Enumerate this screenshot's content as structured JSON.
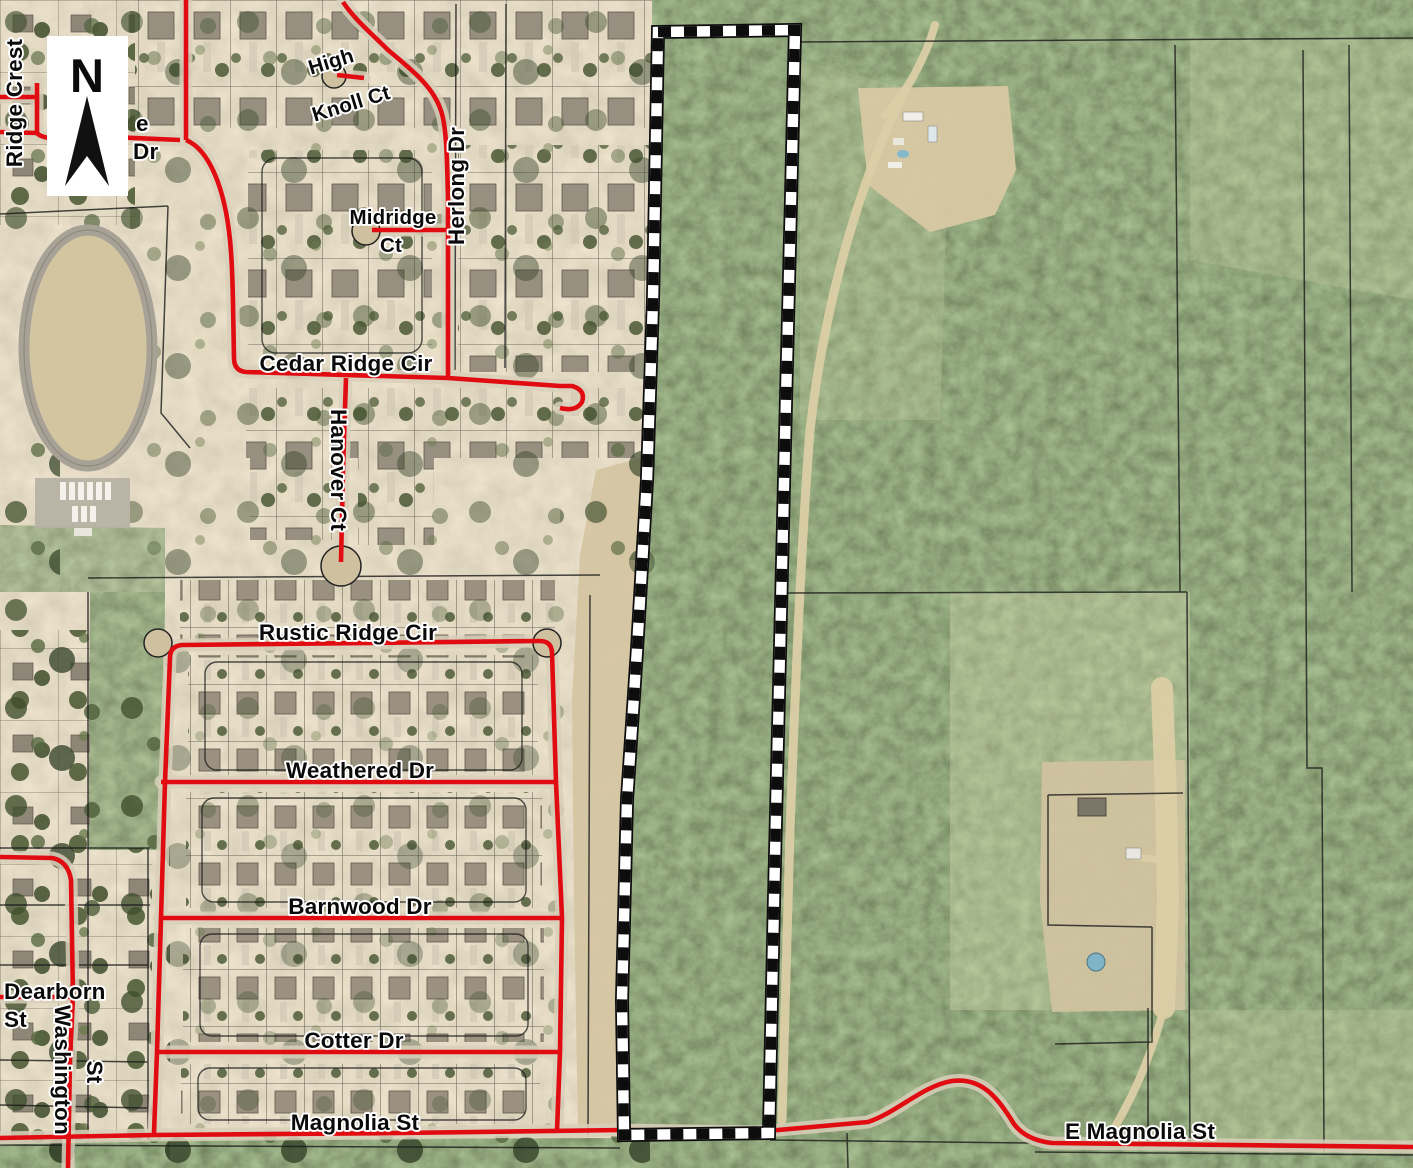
{
  "map_type": "aerial-parcel-map",
  "north_label": "N",
  "streets": {
    "ridge_crest": "Ridge Crest",
    "partial_e": "e",
    "partial_dr": "Dr",
    "high_knoll_1": "High",
    "high_knoll_2": "Knoll Ct",
    "midridge_1": "Midridge",
    "midridge_2": "Ct",
    "herlong": "Herlong Dr",
    "cedar_ridge": "Cedar Ridge Cir",
    "hanover": "Hanover Ct",
    "rustic_ridge": "Rustic Ridge Cir",
    "weathered": "Weathered Dr",
    "barnwood": "Barnwood Dr",
    "dearborn_1": "Dearborn",
    "dearborn_2": "St",
    "washington_1": "Washington",
    "washington_2": "St",
    "cotter": "Cotter Dr",
    "magnolia": "Magnolia St",
    "e_magnolia": "E Magnolia St"
  },
  "colors": {
    "road": "#e10b12",
    "parcel": "#1a1a1a",
    "label": "#0a0a0a",
    "halo": "#ffffff",
    "pavement": "#d8cfba",
    "dirt": "#dbcda5",
    "boundary-black": "#0d0d0d",
    "boundary-white": "#ffffff",
    "forest-green": "#4e5c3a",
    "sand-tan": "#cfc09e"
  }
}
